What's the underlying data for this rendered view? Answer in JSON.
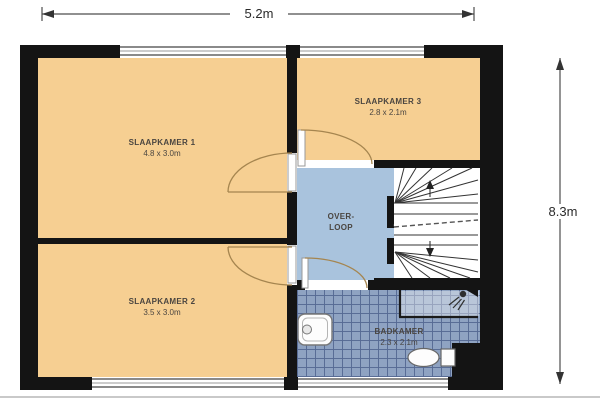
{
  "plan_type": "floor-plan",
  "dimensions": {
    "width_label": "5.2m",
    "height_label": "8.3m"
  },
  "rooms": {
    "slaapkamer1": {
      "name": "SLAAPKAMER 1",
      "size": "4.8 x 3.0m"
    },
    "slaapkamer2": {
      "name": "SLAAPKAMER 2",
      "size": "3.5 x 3.0m"
    },
    "slaapkamer3": {
      "name": "SLAAPKAMER 3",
      "size": "2.8 x 2.1m"
    },
    "overloop": {
      "name_line1": "OVER-",
      "name_line2": "LOOP"
    },
    "badkamer": {
      "name": "BADKAMER",
      "size": "2.3 x 2.1m"
    }
  },
  "icons": {
    "shower_head": "circle-with-spray-lines",
    "stairs_up_arrow": "arrow-up",
    "stairs_down_arrow": "arrow-down",
    "dimension_arrows": "double-headed-arrow"
  },
  "colors": {
    "bedroom_fill": "#f6cf92",
    "hall_fill": "#a9c3dd",
    "bathroom_tile_fill": "#8fa3c2",
    "bathroom_tile_line": "#566a94",
    "wall": "#141414",
    "door_arc": "#a5854f",
    "stairs_line": "#333333",
    "dimension_line": "#4d4d4d"
  }
}
